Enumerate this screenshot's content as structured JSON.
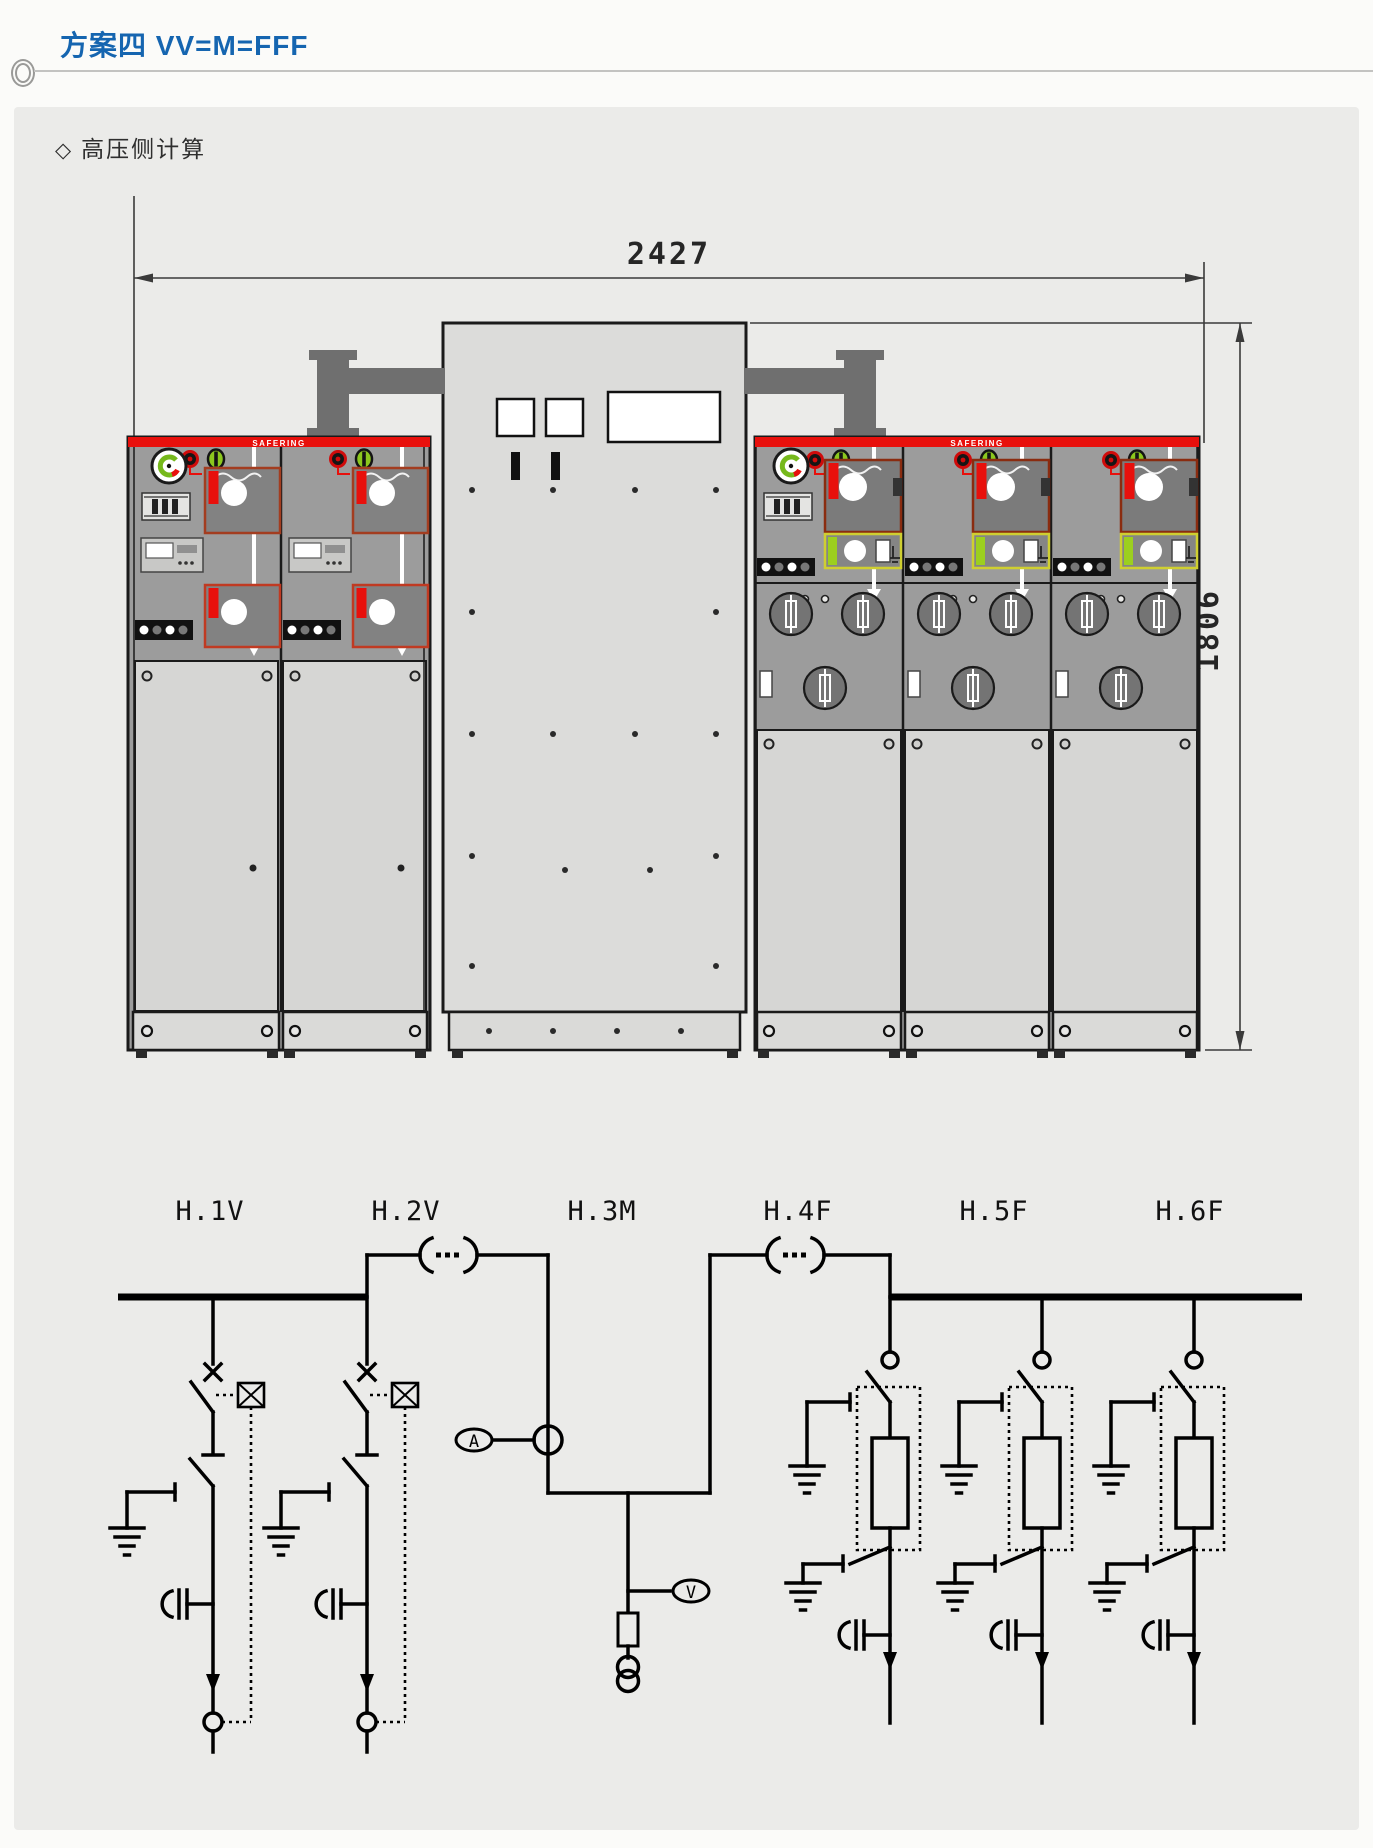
{
  "page": {
    "title": "方案四 VV=M=FFF",
    "section_marker": "◇",
    "section_label": "高压侧计算"
  },
  "colors": {
    "title_blue": "#1565b0",
    "cabinet_red": "#e8100c",
    "panel_gray": "#9c9c9c",
    "door_gray": "#d6d6d4",
    "indicator_green": "#8cc81e",
    "mimic_red_outline": "#a33d20",
    "mimic_yellow_outline": "#cfcf30"
  },
  "cabinet_drawing": {
    "width_dimension": "2427",
    "height_dimension": "1806",
    "brand_label": "SAFERING"
  },
  "schematic": {
    "feeders": [
      {
        "label": "H.1V",
        "type": "V"
      },
      {
        "label": "H.2V",
        "type": "V"
      },
      {
        "label": "H.3M",
        "type": "M"
      },
      {
        "label": "H.4F",
        "type": "F"
      },
      {
        "label": "H.5F",
        "type": "F"
      },
      {
        "label": "H.6F",
        "type": "F"
      }
    ],
    "ammeter_label": "A",
    "voltmeter_label": "V"
  }
}
